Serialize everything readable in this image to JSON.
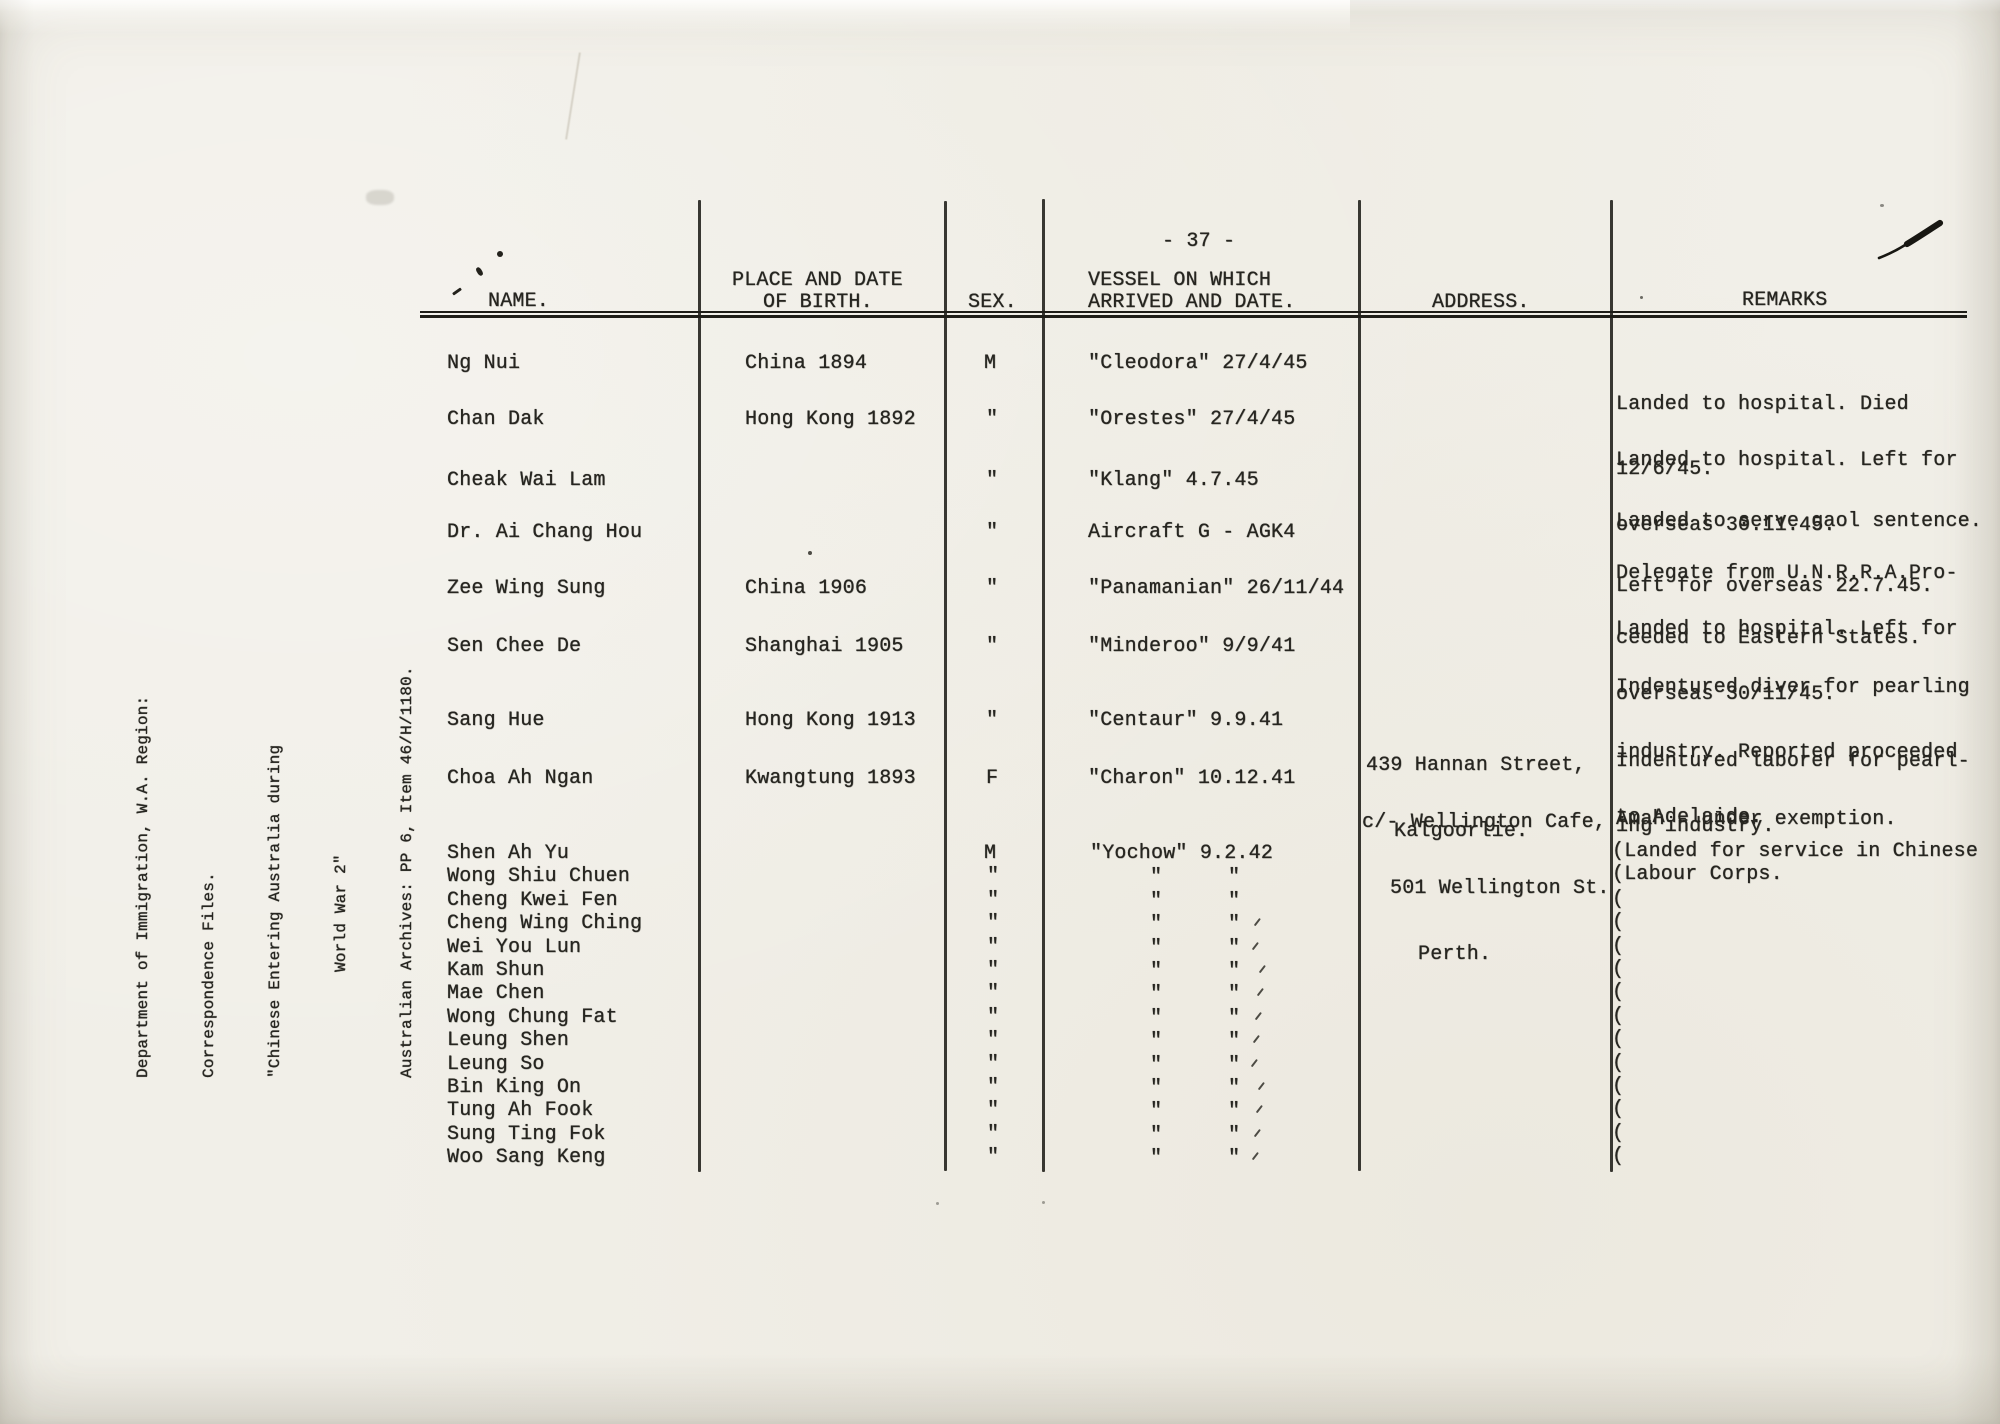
{
  "document": {
    "page_number": "- 37 -",
    "citation_lines": [
      "Department of Immigration, W.A. Region:",
      "Correspondence Files.",
      "\"Chinese Entering Australia during",
      "World War 2\"",
      "Australian Archives: PP 6, Item 46/H/1180."
    ]
  },
  "table": {
    "headers": {
      "name": "NAME.",
      "place_line1": "PLACE AND DATE",
      "place_line2": "OF BIRTH.",
      "sex": "SEX.",
      "vessel_line1": "VESSEL ON WHICH",
      "vessel_line2": "ARRIVED AND DATE.",
      "address": "ADDRESS.",
      "remarks": "REMARKS"
    },
    "rows": [
      {
        "name": "Ng Nui",
        "place": "China 1894",
        "sex": "M",
        "vessel": "\"Cleodora\" 27/4/45",
        "address": [],
        "remarks": [
          "Landed to hospital. Died",
          "12/6/45."
        ]
      },
      {
        "name": "Chan Dak",
        "place": "Hong Kong 1892",
        "sex": "\"",
        "vessel": "\"Orestes\" 27/4/45",
        "address": [],
        "remarks": [
          "Landed to hospital. Left for",
          "overseas 30.11.45."
        ]
      },
      {
        "name": "Cheak Wai Lam",
        "place": "",
        "sex": "\"",
        "vessel": "\"Klang\" 4.7.45",
        "address": [],
        "remarks": [
          "Landed to serve gaol sentence.",
          "Left for overseas 22.7.45."
        ]
      },
      {
        "name": "Dr. Ai Chang Hou",
        "place": "",
        "sex": "\"",
        "vessel": "Aircraft G - AGK4",
        "address": [],
        "remarks": [
          "Delegate from U.N.R.R.A.Pro-",
          "ceeded to Eastern States."
        ]
      },
      {
        "name": "Zee Wing Sung",
        "place": "China 1906",
        "sex": "\"",
        "vessel": "\"Panamanian\" 26/11/44",
        "address": [],
        "remarks": [
          "Landed to hospital. Left for",
          "overseas 30/11/45."
        ]
      },
      {
        "name": "Sen Chee De",
        "place": "Shanghai 1905",
        "sex": "\"",
        "vessel": "\"Minderoo\" 9/9/41",
        "address": [],
        "remarks": [
          "Indentured diver for pearling",
          "industry. Reported proceeded",
          "to Adelaide."
        ]
      },
      {
        "name": "Sang Hue",
        "place": "Hong Kong 1913",
        "sex": "\"",
        "vessel": "\"Centaur\" 9.9.41",
        "address": [
          "439 Hannan Street,",
          "Kalgoorlie."
        ],
        "remarks": [
          "Indentured laborer for pearl-",
          "ing industry."
        ]
      },
      {
        "name": "Choa Ah Ngan",
        "place": "Kwangtung 1893",
        "sex": "F",
        "vessel": "\"Charon\" 10.12.41",
        "address": [
          "c/- Wellington Cafe,",
          "501 Wellington St.",
          "Perth."
        ],
        "remarks": [
          "Amah - under exemption."
        ]
      }
    ],
    "group": {
      "names": [
        "Shen Ah Yu",
        "Wong Shiu Chuen",
        "Cheng Kwei Fen",
        "Cheng Wing Ching",
        "Wei You Lun",
        "Kam Shun",
        "Mae Chen",
        "Wong Chung Fat",
        "Leung Shen",
        "Leung So",
        "Bin King On",
        "Tung Ah Fook",
        "Sung Ting Fok",
        "Woo Sang Keng"
      ],
      "sex_first": "M",
      "ditto": "\"",
      "vessel": "\"Yochow\" 9.2.42",
      "paren": "(",
      "remarks": [
        "(Landed for service in Chinese",
        "(Labour Corps."
      ]
    }
  }
}
